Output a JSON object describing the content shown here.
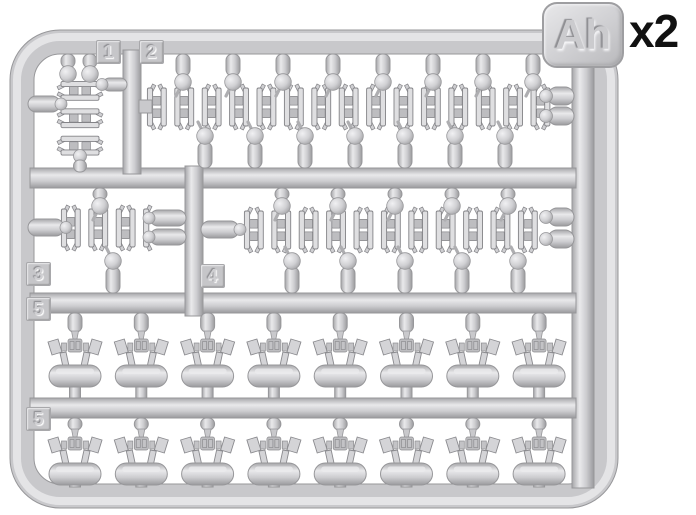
{
  "sprue_code": "Ah",
  "multiplier": "x2",
  "part_labels": [
    "1",
    "2",
    "3",
    "4",
    "5",
    "5"
  ],
  "colors": {
    "plastic_base": "#cdcdd0",
    "plastic_highlight": "#ececee",
    "plastic_shadow": "#9a9a9d",
    "background": "#ffffff",
    "multiplier_text": "#111111"
  }
}
